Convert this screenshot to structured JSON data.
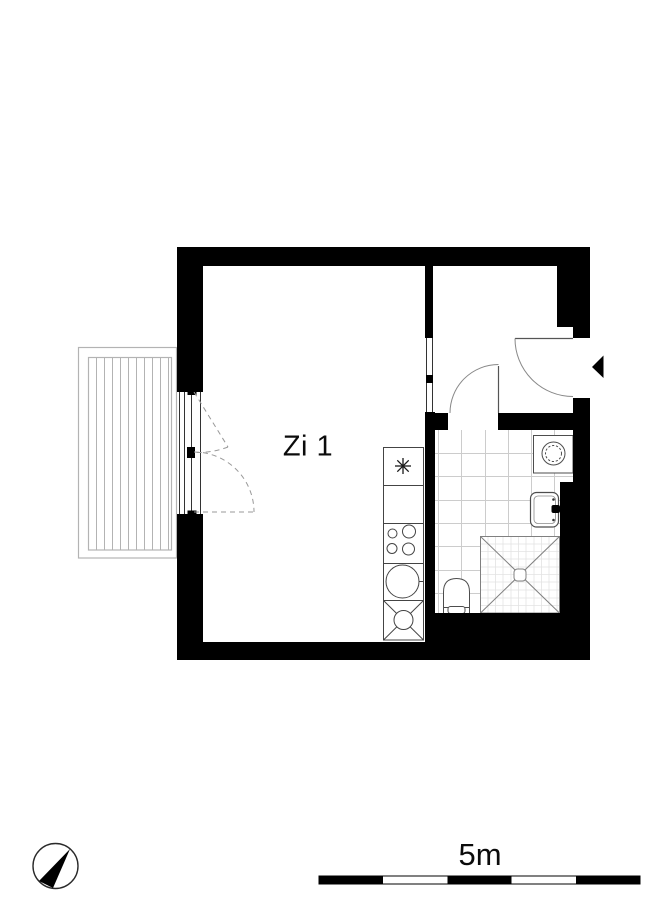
{
  "plan": {
    "room_label": "Zi 1",
    "scale_label": "5m",
    "colors": {
      "wall": "#000000",
      "door_line": "#666666",
      "fixture_line": "#4d4d4d",
      "tile_line": "#cccccc",
      "shower_tile_line": "#e3e3e3",
      "balcony_line": "#b3b3b3",
      "background": "#ffffff"
    },
    "icons": {
      "compass": "compass-icon",
      "entrance_arrow": "entrance-arrow-icon"
    },
    "fixtures": [
      "balcony",
      "balcony-door",
      "interior-opening",
      "kitchenette",
      "hob",
      "kitchen-sink",
      "bathroom-door",
      "entrance-door",
      "washing-machine",
      "bathroom-sink",
      "shower",
      "toilet"
    ]
  }
}
